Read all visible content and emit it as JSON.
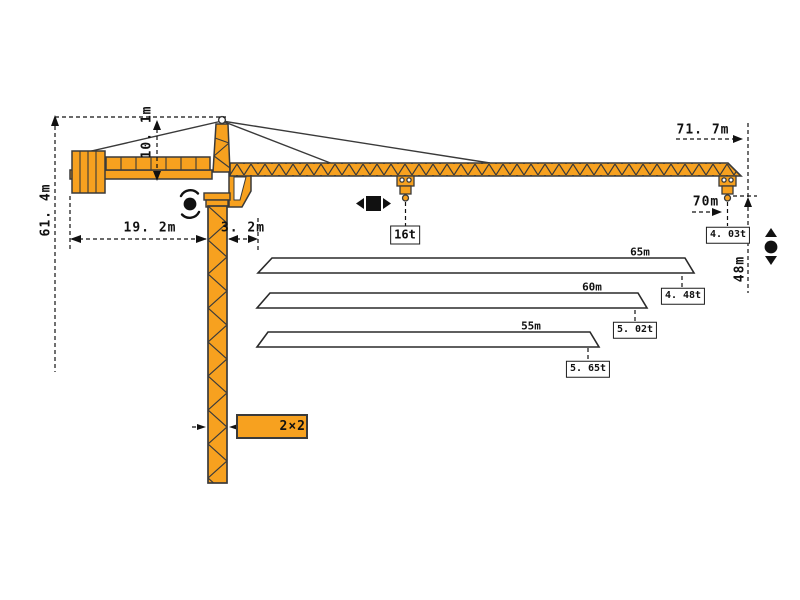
{
  "title": "tower-crane-specification-diagram",
  "colors": {
    "crane": "#F7A11F",
    "outline": "#3a3a3a",
    "ink": "#111111"
  },
  "dimensions": {
    "total_height": "61. 4m",
    "head_height": "10. 1m",
    "counter_jib_length": "19. 2m",
    "tower_to_jib_offset": "3. 2m",
    "max_jib_radius": "71. 7m",
    "tip_hook_radius": "70m",
    "hook_height_under_tip": "48m",
    "mast_section": "2×2"
  },
  "loads": {
    "max_load": "16t",
    "tip_load_at_70m": "4. 03t"
  },
  "profiles": [
    {
      "length": "65m",
      "tip_load": "4. 48t"
    },
    {
      "length": "60m",
      "tip_load": "5. 02t"
    },
    {
      "length": "55m",
      "tip_load": "5. 65t"
    }
  ],
  "symbols": {
    "slewing": "rotation-symbol",
    "trolley": "trolley-travel-symbol",
    "hoist": "hoist-travel-symbol",
    "section": "mast-cross-section-symbol"
  }
}
